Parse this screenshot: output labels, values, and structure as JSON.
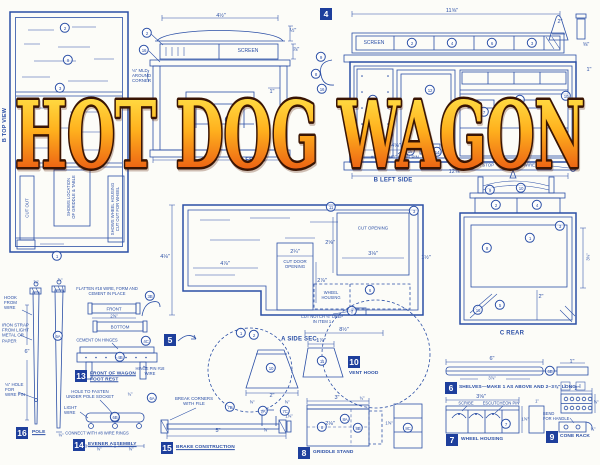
{
  "title": {
    "text": "HOT DOG WAGON"
  },
  "colors": {
    "ink": "#2b4fa6",
    "paper": "#fcfcf8",
    "badge_bg": "#1e3f9c",
    "badge_fg": "#ffffff",
    "title_top": "#ffef55",
    "title_mid": "#ffb21e",
    "title_bottom": "#e33a0e",
    "title_outline": "#3a1503"
  },
  "views": {
    "top": {
      "label": "B TOP VIEW"
    },
    "front": {
      "label": "A FRONT"
    },
    "left_side": {
      "label": "B LEFT SIDE",
      "marker": "4"
    },
    "side_section": {
      "label": "A SIDE SEC.",
      "marker": "5"
    },
    "rear": {
      "label": "C REAR"
    }
  },
  "parts": [
    {
      "num": "4",
      "x": 320,
      "y": 8,
      "label": ""
    },
    {
      "num": "5",
      "x": 164,
      "y": 334,
      "label": ""
    },
    {
      "num": "6",
      "x": 445,
      "y": 382,
      "label": "SHELVES—MAKE 1 AS ABOVE AND 2–3⅞\" LONG",
      "lx": 459,
      "ly": 388,
      "u": 0
    },
    {
      "num": "7",
      "x": 446,
      "y": 434,
      "label": "WHEEL HOUSING",
      "lx": 461,
      "ly": 440,
      "u": 0
    },
    {
      "num": "8",
      "x": 298,
      "y": 447,
      "label": "GRIDDLE STAND",
      "lx": 313,
      "ly": 453,
      "u": 0
    },
    {
      "num": "9",
      "x": 546,
      "y": 431,
      "label": "CONE RACK",
      "lx": 560,
      "ly": 437,
      "u": 0
    },
    {
      "num": "10",
      "x": 348,
      "y": 356,
      "label": "VENT HOOD",
      "lx": 349,
      "ly": 374,
      "u": 0
    },
    {
      "num": "13",
      "x": 75,
      "y": 370,
      "label": "FRONT OF WAGON\nFOOT REST",
      "lx": 90,
      "ly": 377,
      "u": 1
    },
    {
      "num": "14",
      "x": 73,
      "y": 439,
      "label": "EVENER ASSEMBLY",
      "lx": 88,
      "ly": 445,
      "u": 1
    },
    {
      "num": "15",
      "x": 161,
      "y": 442,
      "label": "BRAKE CONSTRUCTION",
      "lx": 176,
      "ly": 448,
      "u": 1
    },
    {
      "num": "16",
      "x": 16,
      "y": 427,
      "label": "POLE",
      "lx": 32,
      "ly": 433,
      "u": 1
    }
  ],
  "annotations": [
    {
      "t": "B TOP VIEW",
      "x": 5,
      "y": 125,
      "fs": 5.5,
      "b": 1,
      "rot": -90,
      "n": "view-label-top"
    },
    {
      "t": "CUT OUT",
      "x": 27,
      "y": 208,
      "fs": 4.4,
      "rot": -90,
      "n": "note"
    },
    {
      "t": "SHOWS LOCATION\nOF GRIDDLE & TABLE",
      "x": 72,
      "y": 197,
      "fs": 4.2,
      "rot": -90,
      "n": "note"
    },
    {
      "t": "SHOWS WHEEL HOUSING\nCUT OUT FOR WHEEL",
      "x": 116,
      "y": 209,
      "fs": 4.2,
      "rot": -90,
      "n": "note"
    },
    {
      "t": "4½\"",
      "x": 221,
      "y": 16
    },
    {
      "t": "½\"",
      "x": 293,
      "y": 31
    },
    {
      "t": "⅞\"",
      "x": 296,
      "y": 50
    },
    {
      "t": "SCREEN",
      "x": 248,
      "y": 52,
      "fs": 5
    },
    {
      "t": "⅛\" MLD\nAROUND\nCORNER",
      "x": 132,
      "y": 76,
      "fs": 4.4,
      "left": 1,
      "n": "note"
    },
    {
      "t": "1\"",
      "x": 272,
      "y": 92
    },
    {
      "t": "6\"",
      "x": 220,
      "y": 152
    },
    {
      "t": "A FRONT",
      "x": 253,
      "y": 161,
      "fs": 6,
      "b": 1,
      "n": "view-label-front"
    },
    {
      "t": "11⅝\"",
      "x": 452,
      "y": 11
    },
    {
      "t": "2\"",
      "x": 560,
      "y": 22
    },
    {
      "t": "⅝\"",
      "x": 586,
      "y": 45
    },
    {
      "t": "1\"",
      "x": 589,
      "y": 70
    },
    {
      "t": "SCREEN",
      "x": 374,
      "y": 44,
      "fs": 5
    },
    {
      "t": "4⅝\"",
      "x": 396,
      "y": 146
    },
    {
      "t": "#20 ESCUTCHEON PIN",
      "x": 371,
      "y": 157,
      "fs": 4.4,
      "left": 1,
      "n": "note"
    },
    {
      "t": "DOOR STOP",
      "x": 481,
      "y": 165,
      "fs": 4.4,
      "n": "note"
    },
    {
      "t": "SOFT WIRE RING",
      "x": 529,
      "y": 165,
      "fs": 4.4,
      "n": "note"
    },
    {
      "t": "12⅝\"",
      "x": 455,
      "y": 172
    },
    {
      "t": "B LEFT SIDE",
      "x": 393,
      "y": 181,
      "fs": 6,
      "b": 1,
      "n": "view-label-left-side"
    },
    {
      "t": "4⅛\"",
      "x": 165,
      "y": 257
    },
    {
      "t": "4⅞\"",
      "x": 225,
      "y": 264
    },
    {
      "t": "2¼\"",
      "x": 295,
      "y": 252
    },
    {
      "t": "CUT DOOR\nOPENING",
      "x": 295,
      "y": 264,
      "fs": 4.4,
      "n": "note"
    },
    {
      "t": "2⅞\"",
      "x": 322,
      "y": 281
    },
    {
      "t": "CUT OPENING",
      "x": 373,
      "y": 228,
      "fs": 4.4,
      "n": "note"
    },
    {
      "t": "2⅝\"",
      "x": 330,
      "y": 243
    },
    {
      "t": "3⅛\"",
      "x": 373,
      "y": 254
    },
    {
      "t": "WHEEL\nHOUSING",
      "x": 331,
      "y": 296,
      "fs": 4.1,
      "n": "note"
    },
    {
      "t": "CUT NOTCH ⅛\" DEEP\nIN ITEM 1",
      "x": 322,
      "y": 320,
      "fs": 4.1,
      "n": "note"
    },
    {
      "t": "8½\"",
      "x": 344,
      "y": 330
    },
    {
      "t": "A SIDE SEC.",
      "x": 300,
      "y": 340,
      "fs": 6,
      "b": 1,
      "n": "view-label-side-sec"
    },
    {
      "t": "C REAR",
      "x": 512,
      "y": 334,
      "fs": 6,
      "b": 1,
      "n": "view-label-rear"
    },
    {
      "t": "2\"",
      "x": 541,
      "y": 297
    },
    {
      "t": "1½\"",
      "x": 426,
      "y": 258
    },
    {
      "t": "3⅜\"",
      "x": 589,
      "y": 257,
      "fs": 4.2,
      "rot": -90
    },
    {
      "t": "HOOK\nFROM\nWIRE",
      "x": 4,
      "y": 303,
      "fs": 4.4,
      "left": 1,
      "n": "note"
    },
    {
      "t": "IRON STRAP\nFROM LIGHT\nMETAL OR\nPAPER",
      "x": 2,
      "y": 333,
      "fs": 4.4,
      "left": 1,
      "n": "note"
    },
    {
      "t": "⅛\" HOLE\nFOR\nWIRE PIN",
      "x": 5,
      "y": 390,
      "fs": 4.4,
      "left": 1,
      "n": "note"
    },
    {
      "t": "6\"",
      "x": 27,
      "y": 352
    },
    {
      "t": "⅝\"",
      "x": 36,
      "y": 283,
      "fs": 4.2
    },
    {
      "t": "⅞\"",
      "x": 60,
      "y": 281,
      "fs": 4.2
    },
    {
      "t": "⅜\"",
      "x": 61,
      "y": 436,
      "fs": 4.2
    },
    {
      "t": "FLATTEN #18 WIRE, FORM AND\nCEMENT IN PLACE",
      "x": 107,
      "y": 292,
      "fs": 4.1,
      "n": "note"
    },
    {
      "t": "FRONT",
      "x": 114,
      "y": 308.5,
      "fs": 4.4
    },
    {
      "t": "2⅝\"",
      "x": 114,
      "y": 317,
      "fs": 4.1
    },
    {
      "t": "BOTTOM",
      "x": 120,
      "y": 327,
      "fs": 4.4
    },
    {
      "t": "CEMENT ON HINGES",
      "x": 97,
      "y": 341,
      "fs": 4.1,
      "n": "note"
    },
    {
      "t": "HINGE PIN #18\nWIRE",
      "x": 150,
      "y": 372,
      "fs": 4.1,
      "n": "note"
    },
    {
      "t": "HOLE TO FASTEN\nUNDER POLE SOCKET",
      "x": 90,
      "y": 394,
      "fs": 4.4,
      "n": "note"
    },
    {
      "t": "¾\"",
      "x": 130,
      "y": 395,
      "fs": 4.1
    },
    {
      "t": "LIGHT\nWIRE",
      "x": 64,
      "y": 410,
      "fs": 4.4,
      "left": 1,
      "n": "note"
    },
    {
      "t": "CONNECT WITH #8 WIRE RINGS",
      "x": 97,
      "y": 434,
      "fs": 4.1,
      "n": "note"
    },
    {
      "t": "⅝\"",
      "x": 99,
      "y": 450,
      "fs": 4.1
    },
    {
      "t": "⅝\"",
      "x": 131,
      "y": 450,
      "fs": 4.1
    },
    {
      "t": "BREAK CORNERS\nWITH FILE",
      "x": 194,
      "y": 401,
      "fs": 4.4,
      "n": "note"
    },
    {
      "t": "5\"",
      "x": 218,
      "y": 431
    },
    {
      "t": "⅝\"",
      "x": 252,
      "y": 403,
      "fs": 4.1
    },
    {
      "t": "⅝\"",
      "x": 287,
      "y": 403,
      "fs": 4.1
    },
    {
      "t": "1⅜\"",
      "x": 289,
      "y": 417,
      "fs": 4.1
    },
    {
      "t": "⅝\"",
      "x": 266,
      "y": 431,
      "fs": 4.1
    },
    {
      "t": "1⅞\"",
      "x": 321,
      "y": 341
    },
    {
      "t": "2\"",
      "x": 272,
      "y": 396
    },
    {
      "t": "3\"",
      "x": 337,
      "y": 398
    },
    {
      "t": "¾\"",
      "x": 362,
      "y": 399,
      "fs": 4.1
    },
    {
      "t": "2⅛\"",
      "x": 330,
      "y": 424
    },
    {
      "t": "1⅝\"",
      "x": 389,
      "y": 424,
      "fs": 4.1
    },
    {
      "t": "6\"",
      "x": 492,
      "y": 359
    },
    {
      "t": "3⅞\"",
      "x": 492,
      "y": 379,
      "fs": 4.1
    },
    {
      "t": "1\"",
      "x": 572,
      "y": 362
    },
    {
      "t": "3⅝\"",
      "x": 481,
      "y": 397
    },
    {
      "t": "SCRIBE",
      "x": 466,
      "y": 404,
      "fs": 4.1,
      "n": "note"
    },
    {
      "t": "ESCUTCHEON PIN",
      "x": 501,
      "y": 404,
      "fs": 4.1,
      "n": "note"
    },
    {
      "t": "1⅝\"",
      "x": 525,
      "y": 420,
      "fs": 4.1
    },
    {
      "t": "1\"",
      "x": 537,
      "y": 402,
      "fs": 4.1
    },
    {
      "t": "2\"",
      "x": 577,
      "y": 389
    },
    {
      "t": "⅝\"",
      "x": 596,
      "y": 403,
      "fs": 4.1
    },
    {
      "t": "BEND\nFOR HANDLE",
      "x": 543,
      "y": 417,
      "fs": 4.1,
      "left": 1,
      "n": "note"
    },
    {
      "t": "¾\"",
      "x": 593,
      "y": 430,
      "fs": 4.1
    }
  ],
  "callouts": [
    {
      "t": "2",
      "x": 65,
      "y": 28
    },
    {
      "t": "9",
      "x": 68,
      "y": 60
    },
    {
      "t": "3",
      "x": 60,
      "y": 88
    },
    {
      "t": "1",
      "x": 57,
      "y": 256
    },
    {
      "t": "2",
      "x": 147,
      "y": 33
    },
    {
      "t": "16",
      "x": 144,
      "y": 50
    },
    {
      "t": "12",
      "x": 230,
      "y": 120
    },
    {
      "t": "3",
      "x": 264,
      "y": 142
    },
    {
      "t": "9",
      "x": 321,
      "y": 57
    },
    {
      "t": "8",
      "x": 316,
      "y": 74
    },
    {
      "t": "16",
      "x": 322,
      "y": 89
    },
    {
      "t": "2",
      "x": 412,
      "y": 43
    },
    {
      "t": "4",
      "x": 452,
      "y": 43
    },
    {
      "t": "6",
      "x": 492,
      "y": 43
    },
    {
      "t": "3",
      "x": 532,
      "y": 43
    },
    {
      "t": "12",
      "x": 430,
      "y": 90
    },
    {
      "t": "1",
      "x": 373,
      "y": 100
    },
    {
      "t": "5",
      "x": 520,
      "y": 100
    },
    {
      "t": "7",
      "x": 484,
      "y": 112
    },
    {
      "t": "13",
      "x": 548,
      "y": 120
    },
    {
      "t": "10",
      "x": 566,
      "y": 96
    },
    {
      "t": "15",
      "x": 410,
      "y": 151
    },
    {
      "t": "14",
      "x": 437,
      "y": 152
    },
    {
      "t": "1",
      "x": 241,
      "y": 333
    },
    {
      "t": "2",
      "x": 254,
      "y": 335
    },
    {
      "t": "7",
      "x": 352,
      "y": 311
    },
    {
      "t": "3",
      "x": 414,
      "y": 211
    },
    {
      "t": "11",
      "x": 331,
      "y": 207
    },
    {
      "t": "6",
      "x": 370,
      "y": 290
    },
    {
      "t": "9",
      "x": 490,
      "y": 190
    },
    {
      "t": "10",
      "x": 521,
      "y": 188
    },
    {
      "t": "2",
      "x": 496,
      "y": 205
    },
    {
      "t": "4",
      "x": 537,
      "y": 205
    },
    {
      "t": "8",
      "x": 487,
      "y": 248
    },
    {
      "t": "1",
      "x": 530,
      "y": 238
    },
    {
      "t": "5",
      "x": 500,
      "y": 305
    },
    {
      "t": "16",
      "x": 478,
      "y": 310
    },
    {
      "t": "3",
      "x": 560,
      "y": 226
    },
    {
      "t": "6A",
      "x": 58,
      "y": 336
    },
    {
      "t": "3B",
      "x": 150,
      "y": 296
    },
    {
      "t": "4C",
      "x": 146,
      "y": 341
    },
    {
      "t": "4B",
      "x": 120,
      "y": 357
    },
    {
      "t": "6A",
      "x": 152,
      "y": 398
    },
    {
      "t": "6B",
      "x": 115,
      "y": 417
    },
    {
      "t": "7B",
      "x": 230,
      "y": 407
    },
    {
      "t": "7A",
      "x": 263,
      "y": 411
    },
    {
      "t": "7C",
      "x": 285,
      "y": 411
    },
    {
      "t": "10",
      "x": 271,
      "y": 368
    },
    {
      "t": "11",
      "x": 322,
      "y": 361
    },
    {
      "t": "8",
      "x": 322,
      "y": 427
    },
    {
      "t": "8A",
      "x": 345,
      "y": 419
    },
    {
      "t": "8B",
      "x": 358,
      "y": 428
    },
    {
      "t": "8C",
      "x": 408,
      "y": 428
    },
    {
      "t": "6B",
      "x": 550,
      "y": 371
    },
    {
      "t": "7",
      "x": 506,
      "y": 424
    }
  ]
}
